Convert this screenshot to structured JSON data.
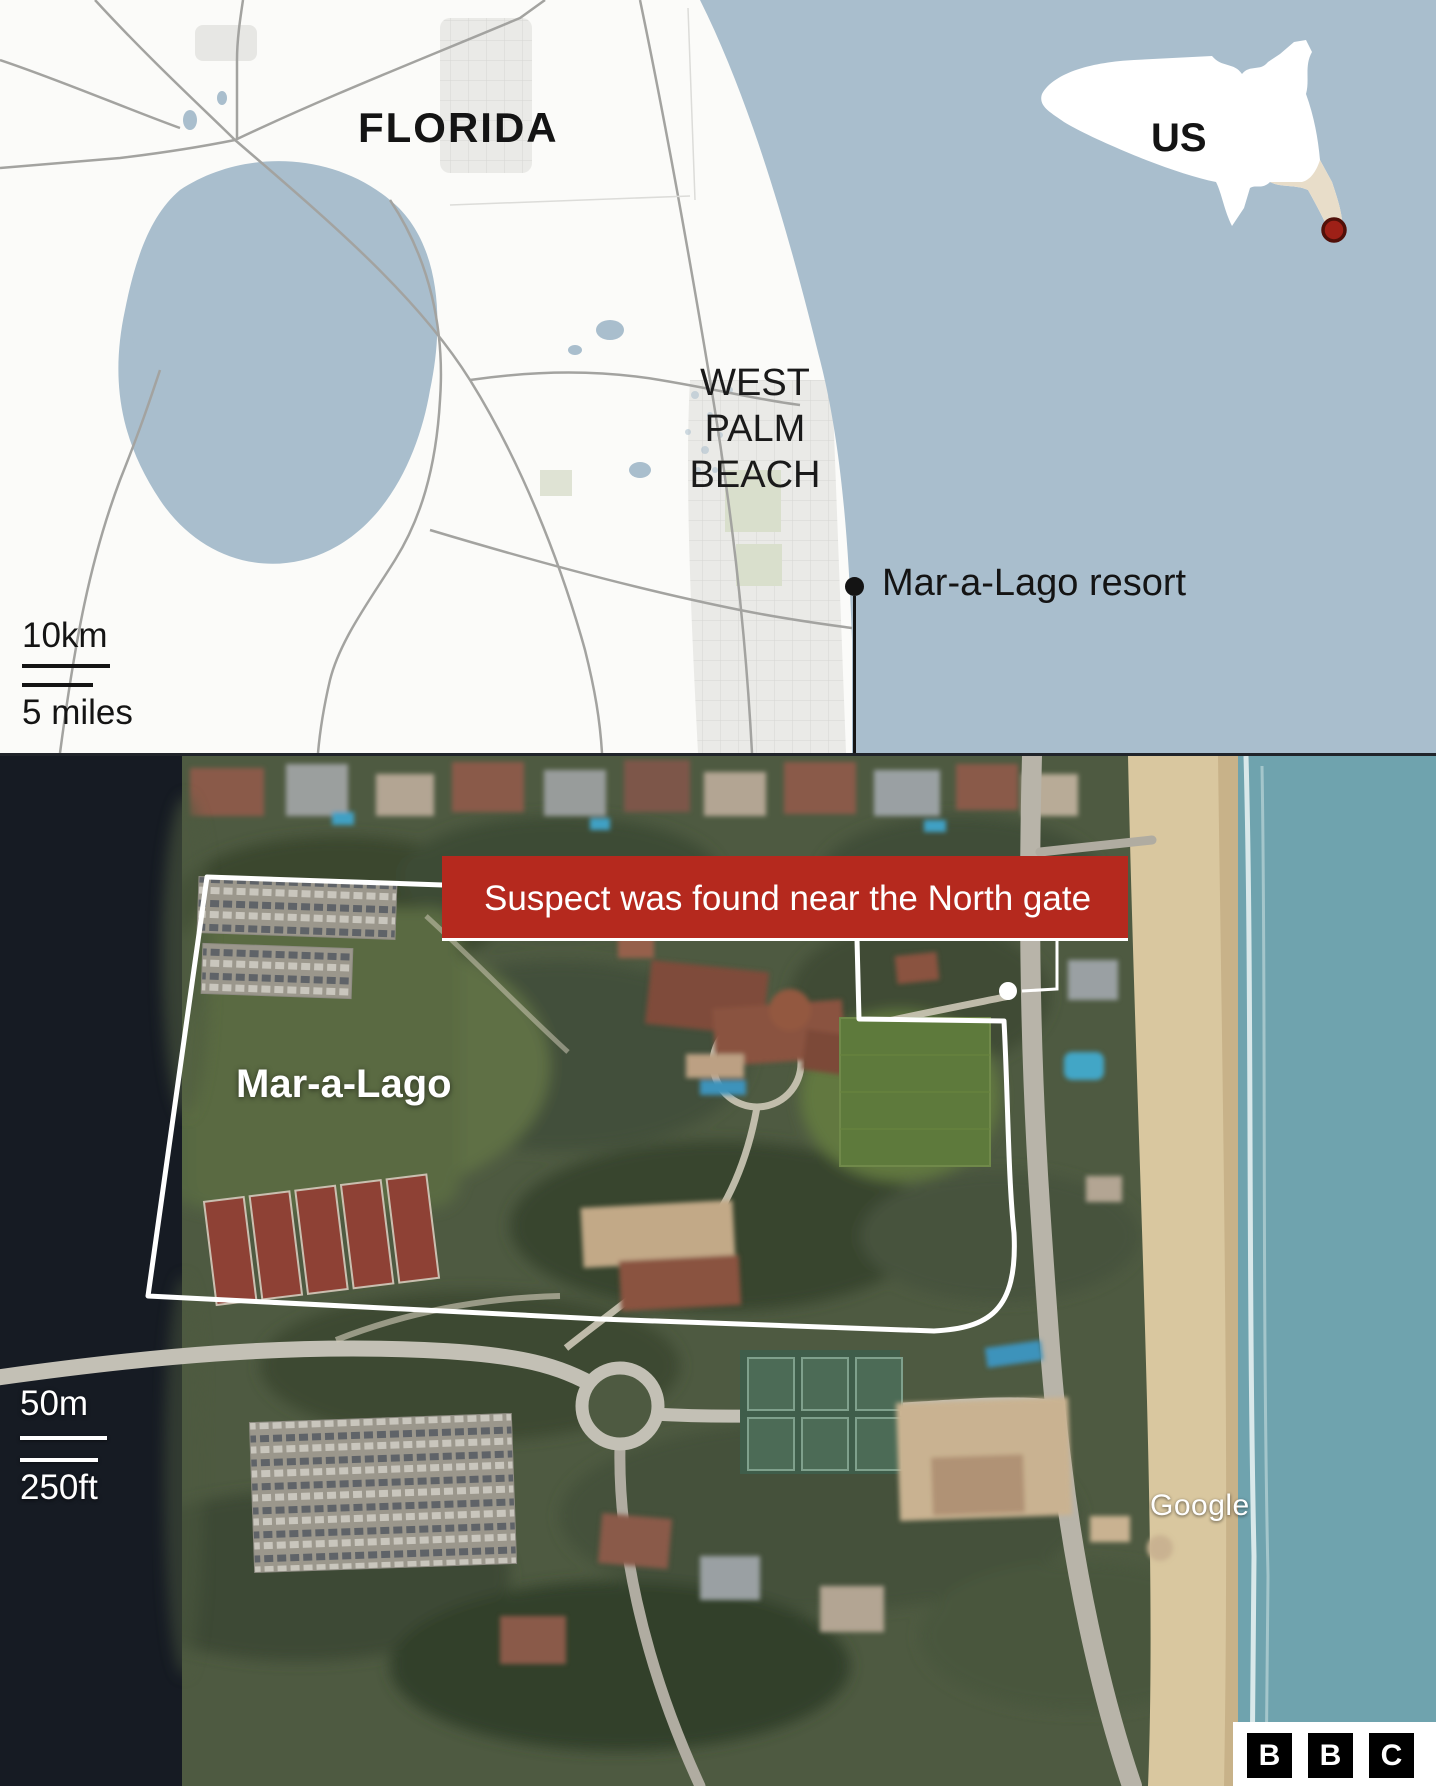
{
  "colors": {
    "banner_red": "#b5291e",
    "location_red": "#9e2017",
    "location_red_stroke": "#511009",
    "map_water": "#a9becd",
    "map_land": "#fbfbf9",
    "inset_florida": "#e8ddc9",
    "outline_white": "#ffffff",
    "ocean_teal": "#6fa3ae",
    "sand": "#d9c79f",
    "dark_water": "#161b23"
  },
  "overview_map": {
    "region_label": "FLORIDA",
    "city_label_lines": [
      "WEST",
      "PALM",
      "BEACH"
    ],
    "scale": {
      "metric": "10km",
      "imperial": "5 miles"
    },
    "marker": {
      "label": "Mar-a-Lago resort",
      "icon": "location-dot"
    },
    "inset": {
      "label": "US",
      "icon": "location-dot"
    }
  },
  "satellite_map": {
    "banner_text": "Suspect was found near the North gate",
    "property_label": "Mar-a-Lago",
    "scale": {
      "metric": "50m",
      "imperial": "250ft"
    },
    "attribution": "Google",
    "gate_marker_icon": "north-gate-dot"
  },
  "footer": {
    "logo": "BBC",
    "logo_letters": [
      "B",
      "B",
      "C"
    ]
  }
}
